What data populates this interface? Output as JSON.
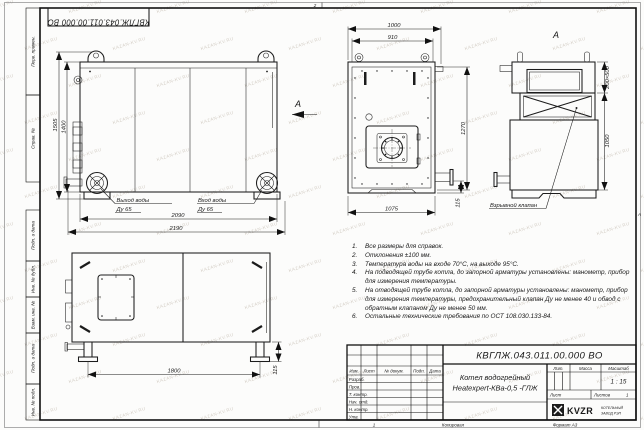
{
  "sheet": {
    "designation_flipped": "КВГЛЖ.043.011.00.000 ВО",
    "zone_top": "2",
    "zone_bottom": "1",
    "zone_right": "А",
    "copied_label": "Копировал",
    "format_label": "Формат А3"
  },
  "watermark": {
    "text": "KAZAN-KV.RU"
  },
  "side_column": [
    "Перв. примен.",
    "Справ. №",
    "Подп. и дата",
    "Инв. № дубл.",
    "Взам. инв. №",
    "Подп. и дата",
    "Инв. № подл."
  ],
  "views": {
    "side": {
      "dim_height_outer": "1505",
      "dim_height_inner": "1400",
      "dim_width_inner": "2090",
      "dim_width_outer": "2190",
      "outlet_line1": "Выход воды",
      "outlet_line2": "Ду 65",
      "inlet_line1": "Вход воды",
      "inlet_line2": "Ду 65",
      "view_arrow_label": "А"
    },
    "front": {
      "dim_top_outer": "1000",
      "dim_top_inner": "910",
      "dim_right": "1270",
      "dim_bottom": "1075",
      "dim_pipe": "115"
    },
    "a": {
      "label": "А",
      "dim_opening": "200×500",
      "dim_height": "1050",
      "callout": "Взрывной клапан"
    },
    "bottom": {
      "dim_span": "1800",
      "dim_leg": "115"
    }
  },
  "notes": {
    "items": [
      {
        "num": "1.",
        "text": "Все размеры для справок."
      },
      {
        "num": "2.",
        "text": "Отклонения ±100 мм."
      },
      {
        "num": "3.",
        "text": "Температура воды на входе 70°С, на выходе 95°С."
      },
      {
        "num": "4.",
        "text": "На подводящей трубе котла, до запорной арматуры установлены: манометр, прибор для измерения температуры."
      },
      {
        "num": "5.",
        "text": "На отводящей трубе котла, до запорной арматуры установлены: манометр, прибор для измерения температуры, предохранительный клапан Ду не менее 40 и обвод с обратным клапаном Ду не менее 50 мм."
      },
      {
        "num": "6.",
        "text": "Остальные технические требования по ОСТ 108.030.133-84."
      }
    ]
  },
  "title_block": {
    "designation": "КВГЛЖ.043.011.00.000 ВО",
    "product_name_line1": "Котел водогрейный",
    "product_name_line2": "Heatexpert-КВа-0,5 -ГЛЖ",
    "header_cols": [
      "Изм.",
      "Лист",
      "№ докум.",
      "Подп.",
      "Дата"
    ],
    "sign_rows": [
      "Разраб.",
      "Пров.",
      "Т. контр.",
      "Нач. отд.",
      "Н. контр.",
      "Утв."
    ],
    "lit_label": "Лит.",
    "mass_label": "Масса",
    "scale_label": "Масштаб",
    "scale_value": "1 : 15",
    "sheet_label": "Лист",
    "sheets_label": "Листов",
    "sheets_value": "1",
    "logo_text": "KVZR",
    "company_line1": "КОТЕЛЬНЫЙ",
    "company_line2": "ЗАВОД РЭП"
  }
}
